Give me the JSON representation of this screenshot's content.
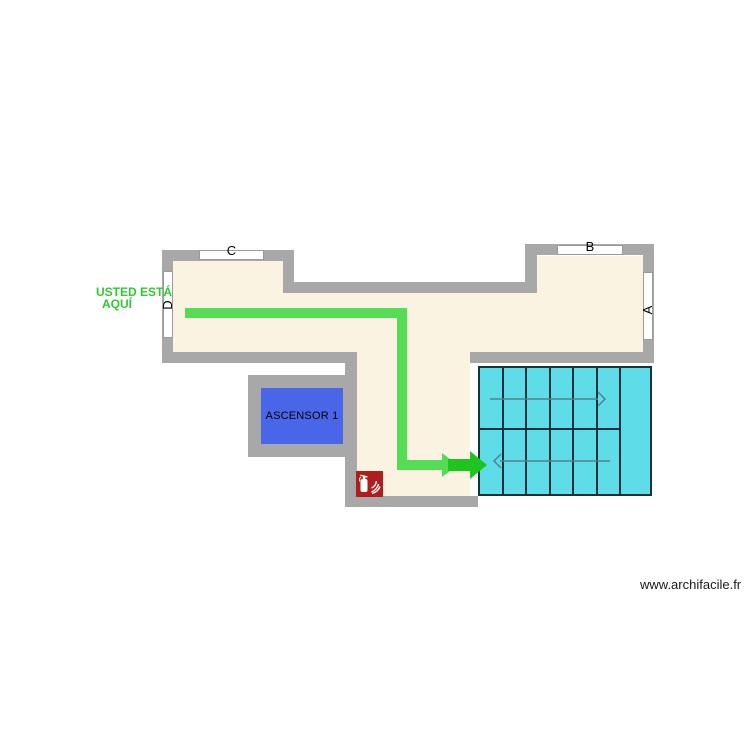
{
  "colors": {
    "wall": "#a8a8a8",
    "floor": "#faf3e1",
    "window_fill": "#ffffff",
    "window_border": "#9a9a9a",
    "stairs_fill": "#5edde9",
    "stairs_border": "#16323a",
    "stair_arrow": "#4f828f",
    "elevator_fill": "#4a66e8",
    "route": "#55dc55",
    "route_arrow": "#1fc51f",
    "you_are_here": "#2fca2f",
    "label": "#000000",
    "extinguisher_bg": "#b01d1d",
    "extinguisher_fg": "#ffffff",
    "watermark": "#1a1a1a"
  },
  "you_are_here": {
    "line1": "USTED ESTÁ",
    "line2": "AQUÍ"
  },
  "elevator": {
    "label": "ASCENSOR 1"
  },
  "openings": {
    "window_c": "C",
    "window_b": "B",
    "window_a": "A",
    "door_d": "D"
  },
  "icons": {
    "fire_extinguisher": "fire-extinguisher-icon",
    "stairs_up_arrow": "arrow-right-outline",
    "stairs_down_arrow": "arrow-left-outline",
    "evacuation_route_arrow": "arrow-right-solid"
  },
  "watermark": "www.archifacile.fr"
}
